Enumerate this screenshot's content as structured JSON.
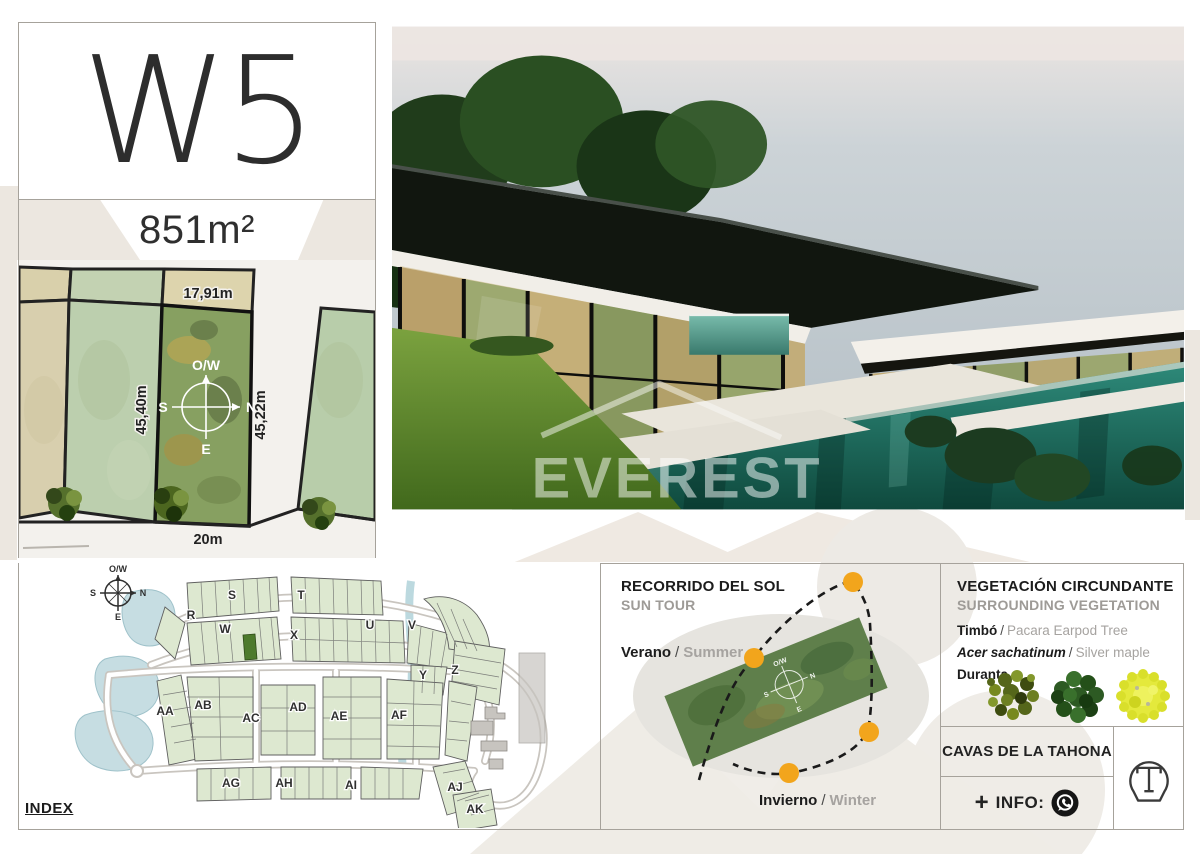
{
  "compass": {
    "top": "O/W",
    "right": "N",
    "left": "S",
    "bottom": "E"
  },
  "plot_card": {
    "lot_id": "W5",
    "area": "851m²",
    "dim_top": "17,91m",
    "dim_left": "45,40m",
    "dim_right": "45,22m",
    "dim_bottom": "20m"
  },
  "photo": {
    "watermark_title": "EVEREST",
    "watermark_subtitle": "REAL ESTATE"
  },
  "index_map": {
    "label": "INDEX",
    "sections": [
      "R",
      "S",
      "T",
      "U",
      "V",
      "W",
      "X",
      "Y",
      "Z",
      "AA",
      "AB",
      "AC",
      "AD",
      "AE",
      "AF",
      "AG",
      "AH",
      "AI",
      "AJ",
      "AK"
    ]
  },
  "sun_tour": {
    "title": "RECORRIDO DEL SOL",
    "subtitle": "SUN TOUR",
    "separator": "/",
    "summer_es": "Verano",
    "summer_en": "Summer",
    "winter_es": "Invierno",
    "winter_en": "Winter",
    "sun_color": "#F2A51C"
  },
  "vegetation": {
    "title": "VEGETACIÓN CIRCUNDANTE",
    "subtitle": "SURROUNDING VEGETATION",
    "separator": "/",
    "items": [
      {
        "name": "Timbó",
        "alt": "Pacara Earpod Tree"
      },
      {
        "name": "Acer sachatinum",
        "alt": "Silver maple"
      },
      {
        "name": "Duranta",
        "alt": ""
      }
    ]
  },
  "footer": {
    "brand": "CAVAS DE LA TAHONA",
    "plus": "+",
    "info_label": "INFO:"
  }
}
